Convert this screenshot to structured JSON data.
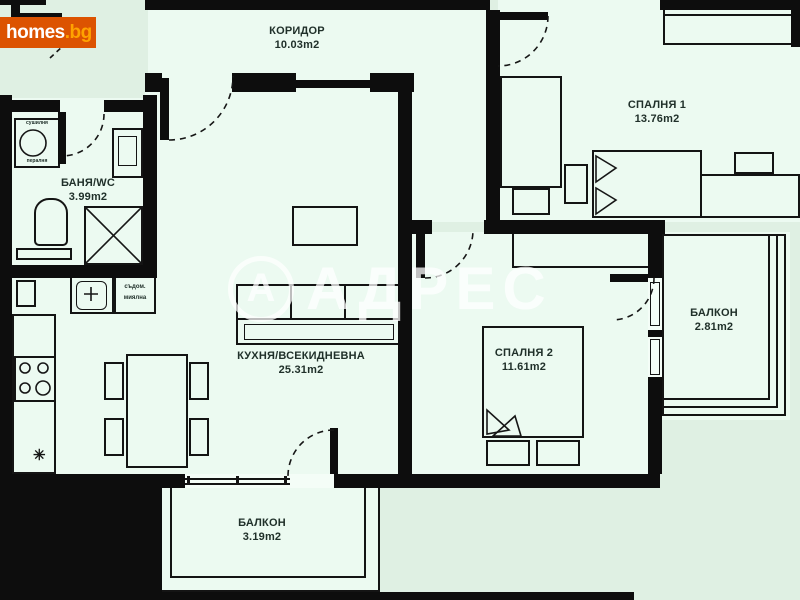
{
  "logo": {
    "primary": "homes",
    "secondary": ".bg"
  },
  "watermark": {
    "monogram": "А",
    "brand": "АДРЕС"
  },
  "rooms": {
    "corridor": {
      "name": "КОРИДОР",
      "area": "10.03m2"
    },
    "bedroom1": {
      "name": "СПАЛНЯ 1",
      "area": "13.76m2"
    },
    "bathroom": {
      "name": "БАНЯ/WC",
      "area": "3.99m2"
    },
    "kitchen_living": {
      "name": "КУХНЯ/ВСЕКИДНЕВНА",
      "area": "25.31m2"
    },
    "bedroom2": {
      "name": "СПАЛНЯ 2",
      "area": "11.61m2"
    },
    "balcony_right": {
      "name": "БАЛКОН",
      "area": "2.81m2"
    },
    "balcony_bottom": {
      "name": "БАЛКОН",
      "area": "3.19m2"
    }
  },
  "appliances": {
    "washer_top": "сушилня",
    "washer_bottom": "пералня",
    "dishwasher_top": "съдом.",
    "dishwasher_bottom": "миялна"
  },
  "symbols": {
    "fridge_star": "✳"
  },
  "colors": {
    "background": "#dff0e3",
    "room_fill": "#ecfaf1",
    "wall": "#0d0d0d",
    "label_text": "#20302a",
    "logo_bg": "#dc5301",
    "logo_text": "#ffffff",
    "logo_accent": "#ffa200",
    "watermark": "rgba(255,255,255,0.75)"
  }
}
